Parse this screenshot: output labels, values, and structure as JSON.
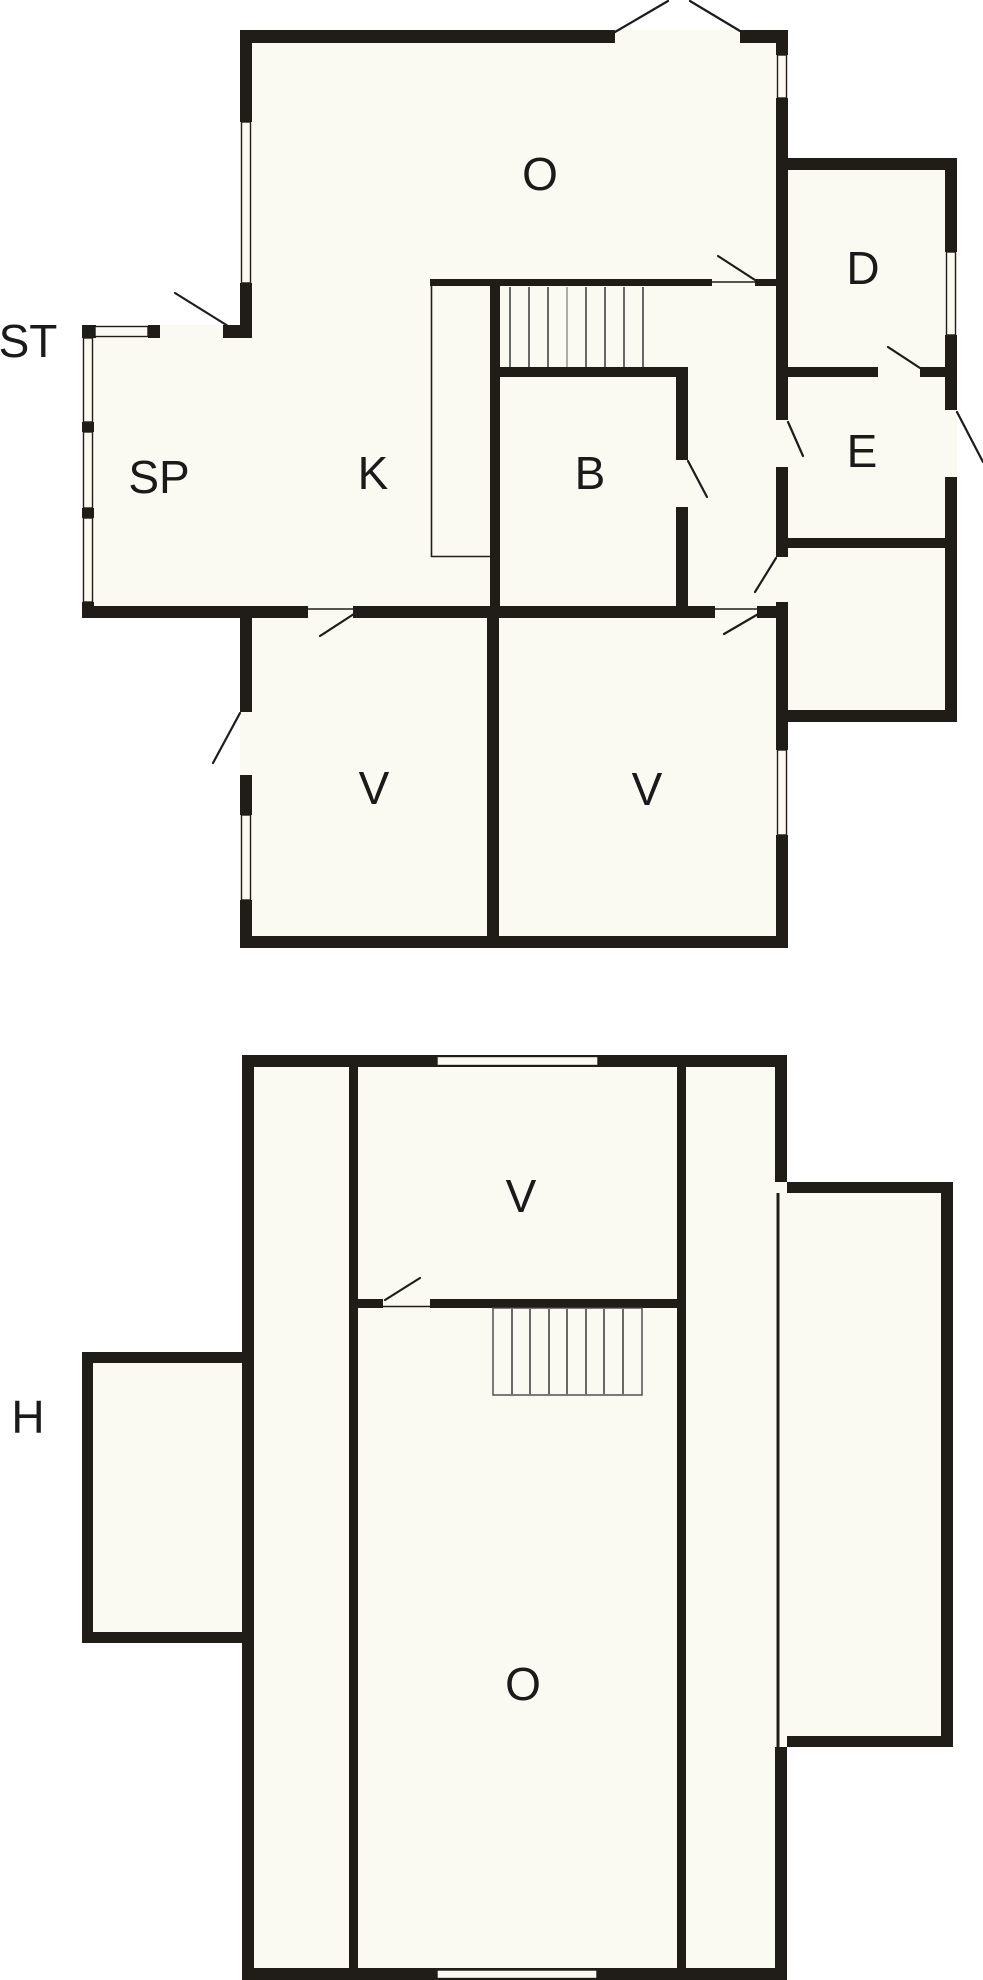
{
  "colors": {
    "wall": "#201d18",
    "floor": "#fbfaf2",
    "background": "#ffffff",
    "label": "#1a1a1a",
    "stair_mid_line": "#8a8a8a"
  },
  "upper_plan": {
    "labels": {
      "o": "O",
      "d": "D",
      "st": "ST",
      "sp": "SP",
      "k": "K",
      "b": "B",
      "e": "E",
      "v_left": "V",
      "v_right": "V"
    }
  },
  "lower_plan": {
    "labels": {
      "v": "V",
      "h": "H",
      "o": "O"
    }
  }
}
